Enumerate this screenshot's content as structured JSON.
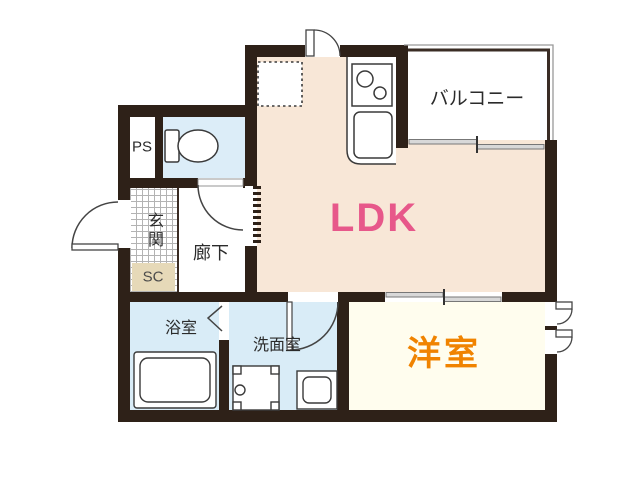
{
  "plan_title": "1LDK apartment floor plan",
  "rooms": {
    "ldk": {
      "label": "LDK",
      "label_color": "#e7588a",
      "fill": "#f8e7d7"
    },
    "balcony": {
      "label": "バルコニー",
      "fill": "#ffffff"
    },
    "western_room": {
      "label": "洋室",
      "label_color": "#f08300",
      "fill": "#fffdee"
    },
    "hallway": {
      "label": "廊下",
      "fill": "#ffffff"
    },
    "entrance": {
      "label": "玄関",
      "floor": "tile-grid-hatch"
    },
    "shoe_closet": {
      "label": "SC",
      "fill": "#e6d9b8"
    },
    "pipe_space": {
      "label": "PS",
      "fill": "#ffffff"
    },
    "bathroom": {
      "label": "浴室",
      "fill": "#d9ecf7"
    },
    "washroom": {
      "label": "洗面室",
      "fill": "#d9ecf7"
    },
    "toilet_room": {
      "label": "",
      "fill": "#dcedf8"
    }
  },
  "fixtures": {
    "toilet-icon": "toilet with tank in toilet room",
    "bathtub-icon": "bathtub in bathroom",
    "washing-machine-pan-icon": "washing machine pan with drain in washroom",
    "washbasin-icon": "vanity washbasin in washroom",
    "stove-icon": "two-burner stove in kitchen counter",
    "kitchen-sink-icon": "kitchen sink in kitchen counter",
    "refrigerator-space": "dotted square refrigerator space in LDK",
    "entrance-door": "outward swing front door at entrance",
    "toilet-door": "swing door from toilet to hallway",
    "washroom-door": "swing door from LDK to washroom",
    "bathroom-folding-door": "folding door between washroom and bathroom",
    "hallway-sliding-door": "sliding door between hallway and LDK",
    "balcony-sliding-window": "sliding glass window between LDK and balcony",
    "bedroom-sliding-door": "sliding door between LDK and western room",
    "top-casement-window": "casement window on LDK top wall",
    "bedroom-casement-windows": "two casement windows on western room right wall"
  },
  "colors": {
    "wall": "#2e2118",
    "ldk_fill": "#f8e7d7",
    "water_room_fill": "#d9ecf7",
    "toilet_fill": "#dcedf8",
    "western_room_fill": "#fffdee",
    "shoe_closet_fill": "#e6d9b8",
    "ldk_label": "#e7588a",
    "western_room_label": "#f08300",
    "fixture_line": "#3a3a3a"
  }
}
